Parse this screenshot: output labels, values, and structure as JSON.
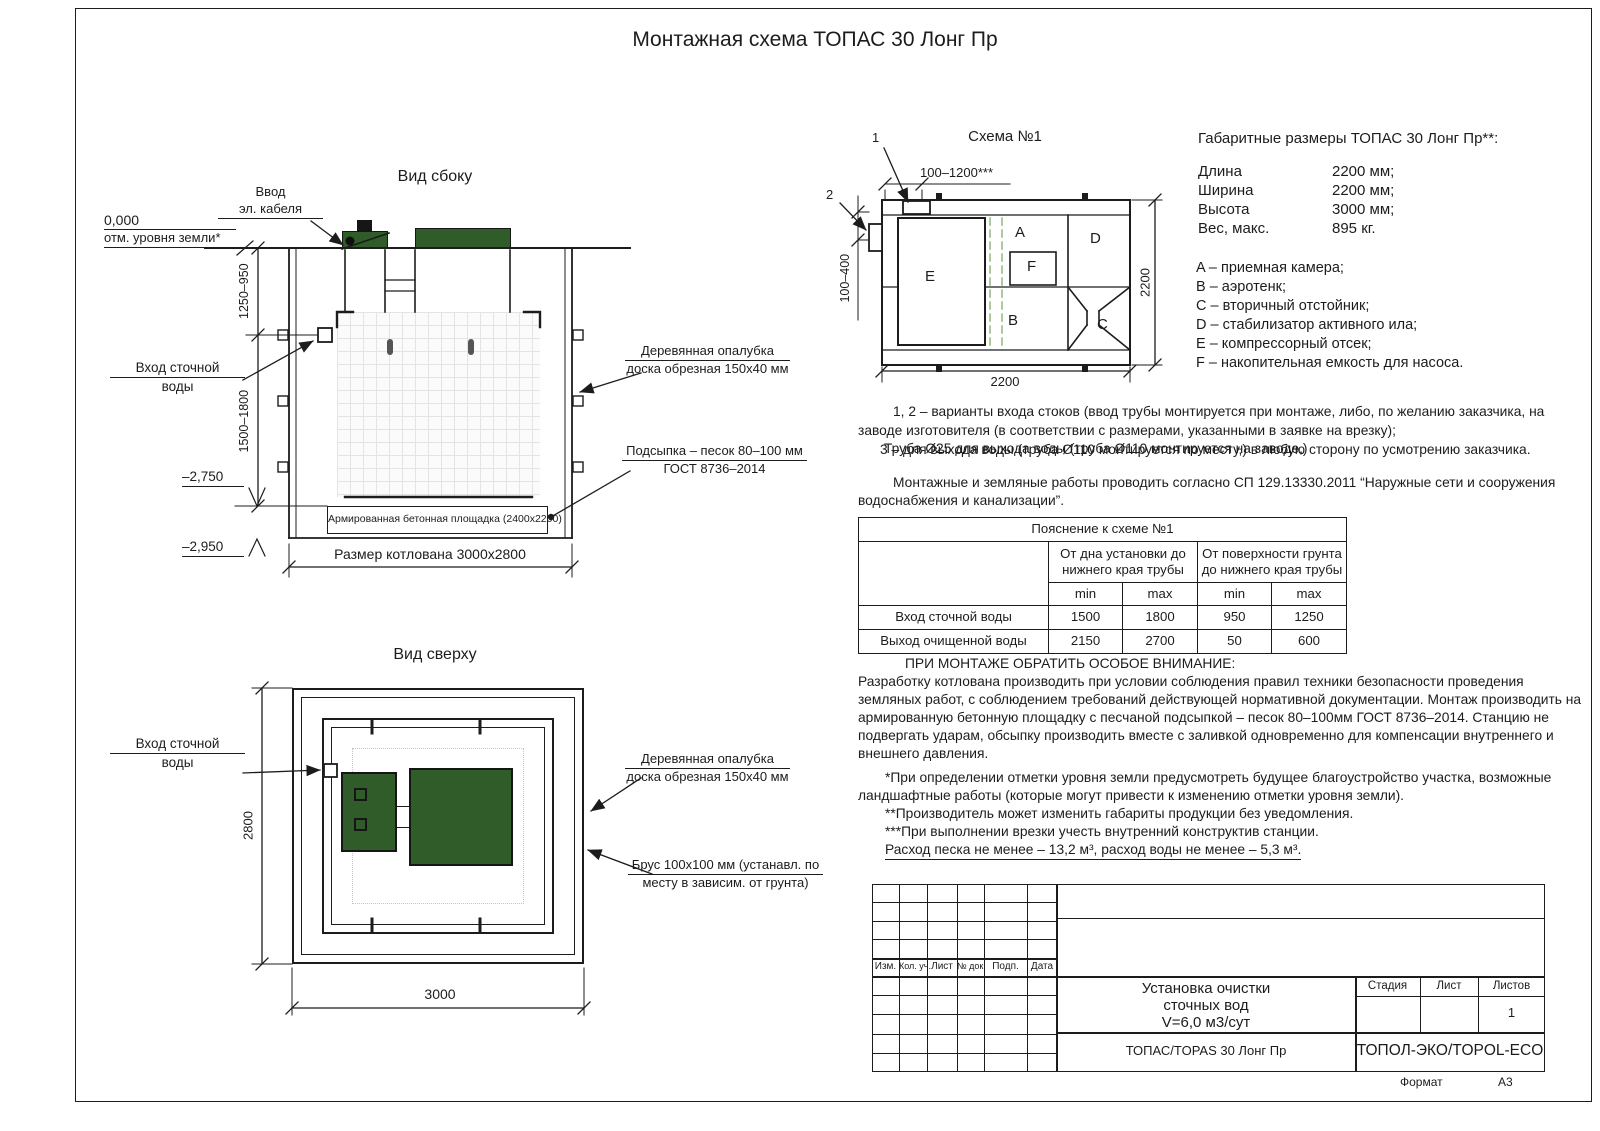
{
  "title": "Монтажная схема ТОПАС 30 Лонг Пр",
  "side_view": {
    "heading": "Вид сбоку",
    "zero_mark": "0,000",
    "ground_level": "отм. уровня земли*",
    "cable_entry_1": "Ввод",
    "cable_entry_2": "эл. кабеля",
    "inlet_1": "Вход сточной",
    "inlet_2": "воды",
    "formwork_1": "Деревянная опалубка",
    "formwork_2": "доска обрезная 150х40 мм",
    "bedding_1": "Подсыпка – песок 80–100 мм",
    "bedding_2": "ГОСТ 8736–2014",
    "slab": "Армированная бетонная площадка (2400х2200)",
    "pit_size": "Размер котлована 3000х2800",
    "dim_upper": "1250–950",
    "dim_lower": "1500–1800",
    "elev_1": "–2,750",
    "elev_2": "–2,950"
  },
  "top_view": {
    "heading": "Вид сверху",
    "inlet_1": "Вход сточной",
    "inlet_2": "воды",
    "formwork_1": "Деревянная опалубка",
    "formwork_2": "доска обрезная 150х40 мм",
    "beam_1": "Брус 100х100 мм (устанавл. по",
    "beam_2": "месту в зависим. от грунта)",
    "dim_width": "2800",
    "dim_length": "3000"
  },
  "schema": {
    "heading": "Схема №1",
    "callout_1": "1",
    "callout_2": "2",
    "dim_top": "100–1200***",
    "dim_left": "100–400",
    "dim_right": "2200",
    "dim_bottom": "2200",
    "comp_a": "A",
    "comp_b": "B",
    "comp_c": "C",
    "comp_d": "D",
    "comp_e": "E",
    "comp_f": "F"
  },
  "dimensions": {
    "heading": "Габаритные размеры ТОПАС 30 Лонг Пр**:",
    "rows": [
      {
        "label": "Длина",
        "value": "2200 мм;"
      },
      {
        "label": "Ширина",
        "value": "2200 мм;"
      },
      {
        "label": "Высота",
        "value": "3000 мм;"
      },
      {
        "label": "Вес, макс.",
        "value": "895 кг."
      }
    ],
    "legend": [
      "A – приемная камера;",
      "B – аэротенк;",
      "C – вторичный отстойник;",
      "D – стабилизатор активного ила;",
      "E – компрессорный отсек;",
      "F – накопительная емкость для насоса."
    ]
  },
  "notes": {
    "variants_line1": "1, 2 – варианты входа  стоков (ввод трубы монтируется при монтаже, либо, по желанию заказчика, на",
    "variants_line2": "заводе изготовителя (в соответствии с размерами, указанными в заявке на врезку);",
    "overlap_a": "Труба Ø25 для выхода воды (труба Ø110 монтируется на заводе,)",
    "overlap_b": "3 – для выхода воды (труба Ø110 монтируется по месту,) в любую сторону по усмотрению заказчика.",
    "works_line1": "Монтажные и земляные работы проводить согласно СП 129.13330.2011 “Наружные сети и сооружения",
    "works_line2": "водоснабжения и канализации”."
  },
  "table": {
    "title": "Пояснение к схеме №1",
    "col_group_1": "От дна установки до нижнего края трубы",
    "col_group_2": "От поверхности грунта до нижнего края трубы",
    "min1": "min",
    "max1": "max",
    "min2": "min",
    "max2": "max",
    "rows": [
      {
        "label": "Вход сточной воды",
        "values": [
          "1500",
          "1800",
          "950",
          "1250"
        ]
      },
      {
        "label": "Выход очищенной воды",
        "values": [
          "2150",
          "2700",
          "50",
          "600"
        ]
      }
    ]
  },
  "attention": {
    "heading": "ПРИ МОНТАЖЕ ОБРАТИТЬ ОСОБОЕ ВНИМАНИЕ:",
    "body_lines": [
      "Разработку котлована производить при условии соблюдения правил техники безопасности проведения",
      "земляных работ, с соблюдением требований действующей нормативной документации.  Монтаж производить на",
      "армированную бетонную площадку с песчаной подсыпкой – песок 80–100мм ГОСТ 8736–2014. Станцию не",
      "подвергать ударам, обсыпку производить вместе с заливкой одновременно для компенсации внутреннего и",
      "внешнего давления."
    ],
    "note1_line1": "*При определении отметки уровня земли предусмотреть будущее благоустройство участка, возможные",
    "note1_line2": "ландшафтные работы (которые могут привести к изменению отметки уровня земли).",
    "note2": "**Производитель может изменить габариты продукции без уведомления.",
    "note3": "***При выполнении врезки учесть внутренний конструктив станции.",
    "sand": "Расход песка не менее – 13,2 м³, расход воды не менее – 5,3 м³."
  },
  "title_block": {
    "stamp_headers": [
      "Изм.",
      "Кол. уч.",
      "Лист",
      "№ док.",
      "Подп.",
      "Дата"
    ],
    "doc_title_1": "Установка очистки",
    "doc_title_2": "сточных вод",
    "doc_title_3": "V=6,0 м3/сут",
    "model": "ТОПАС/TOPAS 30 Лонг Пр",
    "stage": "Стадия",
    "sheet": "Лист",
    "sheets": "Листов",
    "sheets_value": "1",
    "company": "ТОПОЛ-ЭКО/TOPOL-ECO",
    "format_label": "Формат",
    "format_value": "А3"
  },
  "colors": {
    "line": "#1c1c1c",
    "lid_green": "#2f5c28",
    "dashed_green": "#8ab573"
  }
}
